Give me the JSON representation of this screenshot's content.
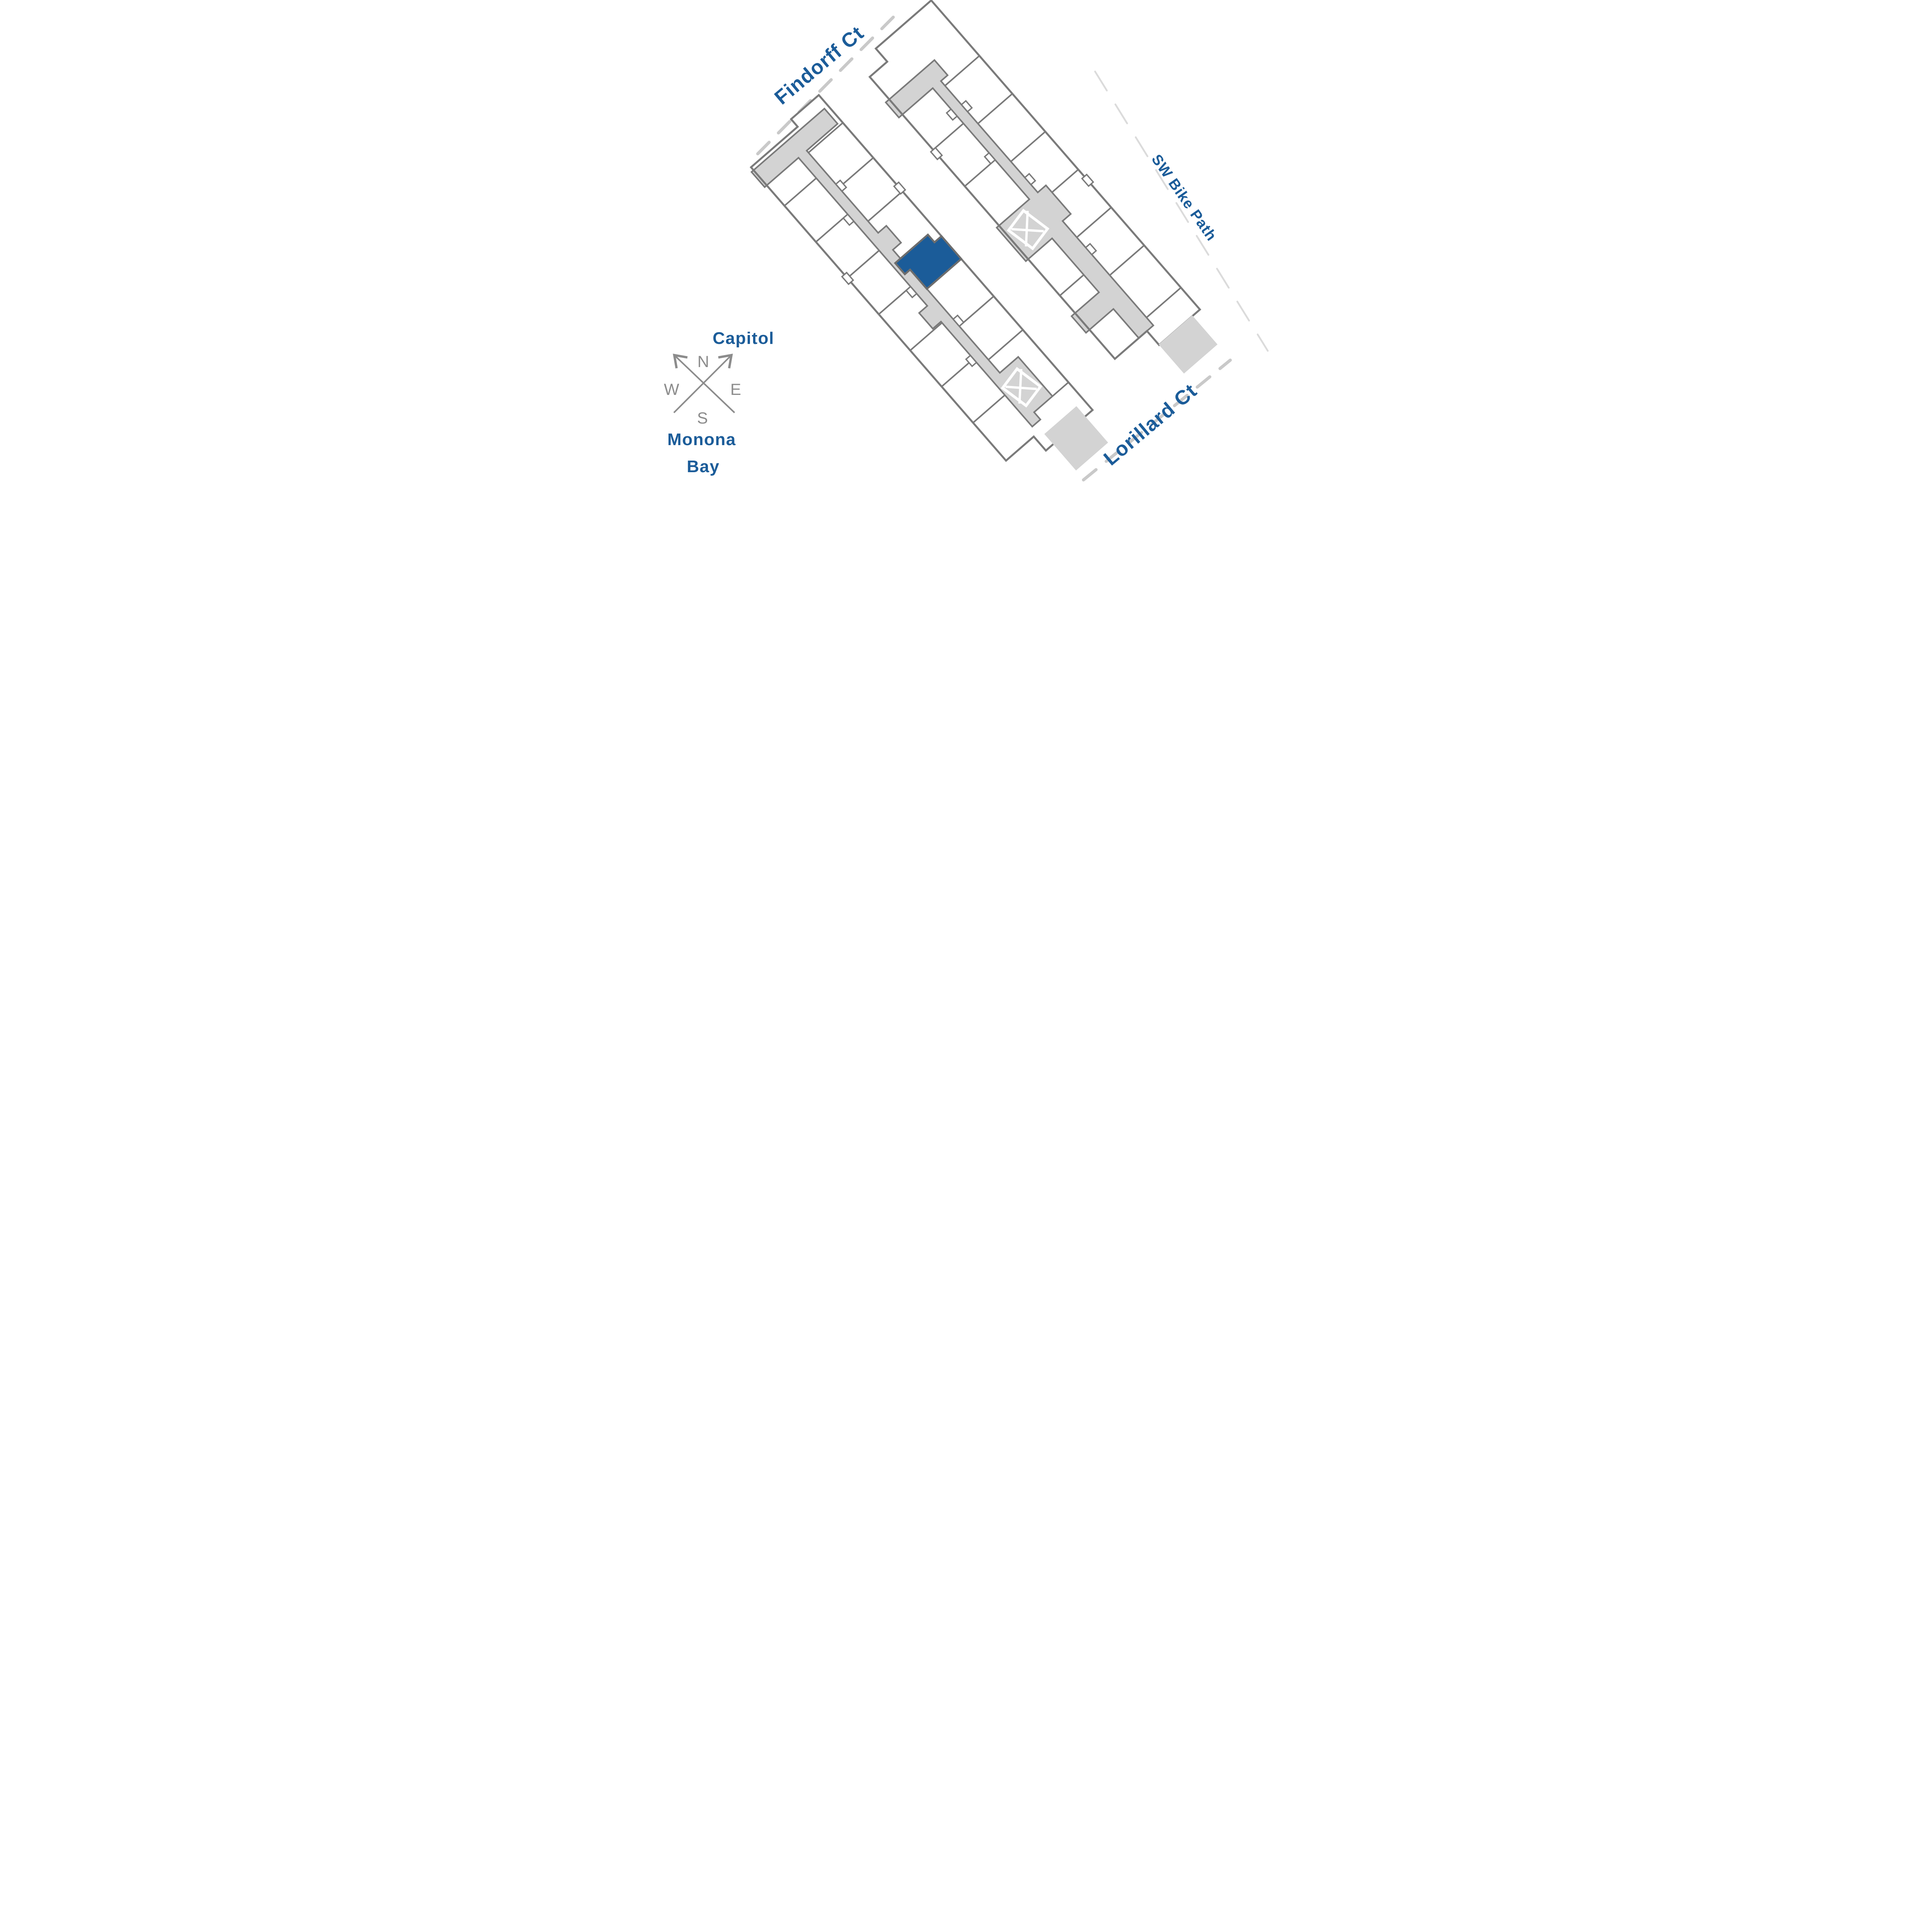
{
  "colors": {
    "brand_blue": "#1B5C99",
    "wall_gray": "#7A7A7A",
    "corridor_gray": "#D3D3D3",
    "street_dash_gray": "#C9C9C9",
    "bikepath_dash_gray": "#DBDBDB",
    "compass_gray": "#8C8C8C",
    "highlight_border": "#6D6D6D",
    "background": "#FFFFFF"
  },
  "streets": {
    "findorff": "Findorff Ct",
    "bike_path": "SW Bike Path",
    "lorillard": "Lorillard Ct"
  },
  "landmarks": {
    "capitol": "Capitol",
    "monona_bay_line1": "Monona",
    "monona_bay_line2": "Bay"
  },
  "compass": {
    "north": "N",
    "east": "E",
    "south": "S",
    "west": "W"
  }
}
